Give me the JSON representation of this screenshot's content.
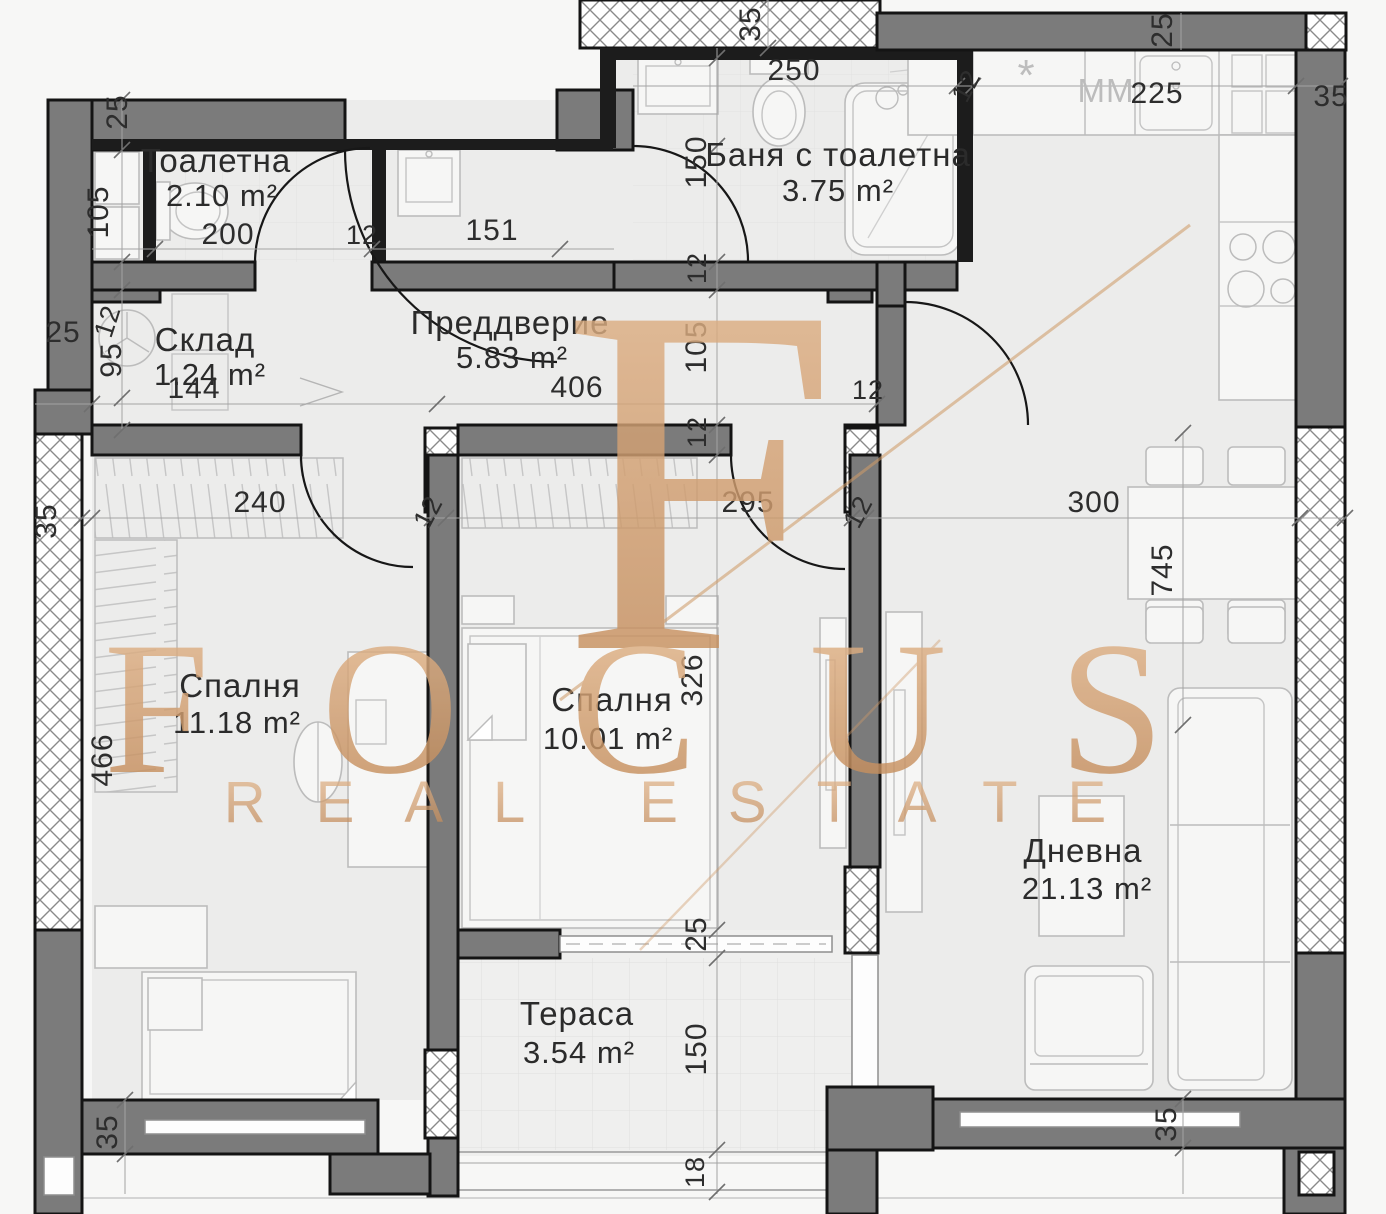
{
  "brand": {
    "monogram": "F",
    "name": "FOCUS",
    "tagline": "REAL ESTATE"
  },
  "rooms": {
    "toilet": {
      "name": "Тоалетна",
      "area": "2.10 m²"
    },
    "bathroom": {
      "name": "Баня с тоалетна",
      "area": "3.75 m²"
    },
    "hallway": {
      "name": "Преддверие",
      "area": "5.83 m²"
    },
    "storage": {
      "name": "Склад",
      "area": "1.24 m²"
    },
    "bedroom1": {
      "name": "Спалня",
      "area": "11.18 m²"
    },
    "bedroom2": {
      "name": "Спалня",
      "area": "10.01 m²"
    },
    "living": {
      "name": "Дневна",
      "area": "21.13 m²"
    },
    "terrace": {
      "name": "Тераса",
      "area": "3.54 m²"
    }
  },
  "appliances": {
    "washing_machine": "MM",
    "boiler_mark": "*"
  },
  "dimensions": [
    {
      "t": "25"
    },
    {
      "t": "105"
    },
    {
      "t": "200"
    },
    {
      "t": "12"
    },
    {
      "t": "151"
    },
    {
      "t": "95"
    },
    {
      "t": "144"
    },
    {
      "t": "25"
    },
    {
      "t": "406"
    },
    {
      "t": "150"
    },
    {
      "t": "12"
    },
    {
      "t": "105"
    },
    {
      "t": "12"
    },
    {
      "t": "12"
    },
    {
      "t": "35"
    },
    {
      "t": "240"
    },
    {
      "t": "12"
    },
    {
      "t": "295"
    },
    {
      "t": "12"
    },
    {
      "t": "300"
    },
    {
      "t": "745"
    },
    {
      "t": "466"
    },
    {
      "t": "326"
    },
    {
      "t": "35"
    },
    {
      "t": "250"
    },
    {
      "t": "12"
    },
    {
      "t": "25"
    },
    {
      "t": "225"
    },
    {
      "t": "35"
    },
    {
      "t": "25"
    },
    {
      "t": "150"
    },
    {
      "t": "18"
    },
    {
      "t": "35"
    },
    {
      "t": "35"
    },
    {
      "t": "12"
    }
  ]
}
